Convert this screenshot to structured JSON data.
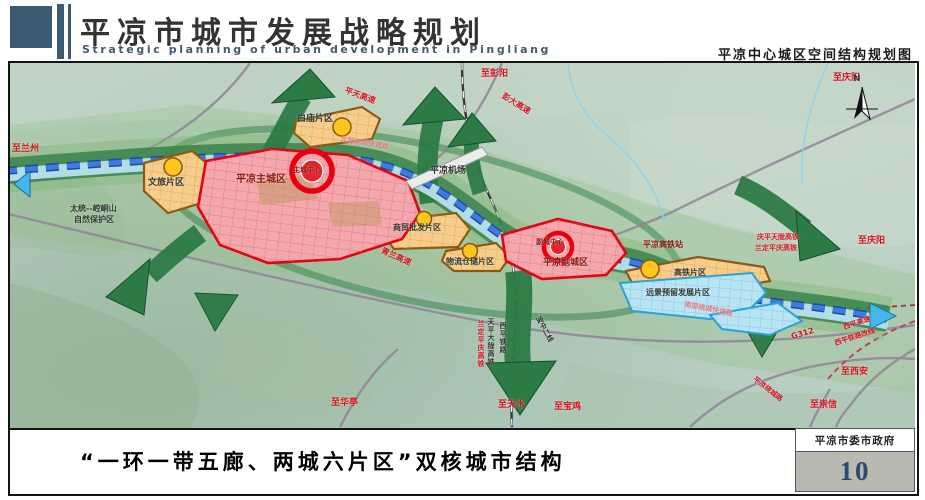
{
  "header": {
    "title": "平凉市城市发展战略规划",
    "subtitle_en": "Strategic planning of urban development in Pingliang",
    "map_title": "平凉中心城区空间结构规划图"
  },
  "footer": {
    "caption": "“一环一带五廊、两城六片区”双核城市结构",
    "agency": "平凉市委市政府",
    "page_number": "10"
  },
  "compass": {
    "north": "N"
  },
  "colors": {
    "accent_slate": "#3c5a73",
    "district_red": "#e60012",
    "district_orange": "#cf7f1f",
    "corridor_green": "#2c7a44",
    "belt_blue": "#2a6ad0",
    "reserve_blue": "#2aa0d6"
  },
  "map": {
    "labels": {
      "to_pengyang": "至彭阳",
      "to_qingyang_top": "至庆阳",
      "to_qingyang_right": "至庆阳",
      "to_lanzhou": "至兰州",
      "to_xian": "至西安",
      "to_chongxin": "至崇信",
      "to_huating": "至华亭",
      "to_tianshui": "至天水",
      "to_baoji": "至宝鸡",
      "pingtian_expwy": "平天高速",
      "pengda_expwy": "彭大高速",
      "qinglan_expwy": "青兰高速",
      "north_ring": "北部绕城快速路",
      "south_ring": "南部绕城快速路",
      "g312": "G312",
      "xiping_expwy": "西平高速",
      "xiping_rail": "西平铁路改线",
      "pl_ring_road": "平凉绕城路",
      "qptl_hsr": "庆平天陇高铁",
      "ldpq_hsr": "兰定平庆高铁",
      "rail_v1": "兰定平庆高铁",
      "rail_v2": "天平大陇高铁",
      "rail_v3": "西平铁路",
      "baozhong_line": "宝中二线",
      "airport": "平凉机场",
      "hsr_station": "平凉高铁站",
      "main_city": "平凉主城区",
      "main_center": "主城中心",
      "sub_city": "平凉副城区",
      "sub_center": "副城中心",
      "baimiao": "白庙片区",
      "wenlv": "文旅片区",
      "shangmao": "商贸批发片区",
      "wuliu": "物流仓储片区",
      "gaotie": "高铁片区",
      "yuanjing": "远景预留发展片区",
      "reserve_line1": "太统--崆峒山",
      "reserve_line2": "自然保护区"
    }
  }
}
